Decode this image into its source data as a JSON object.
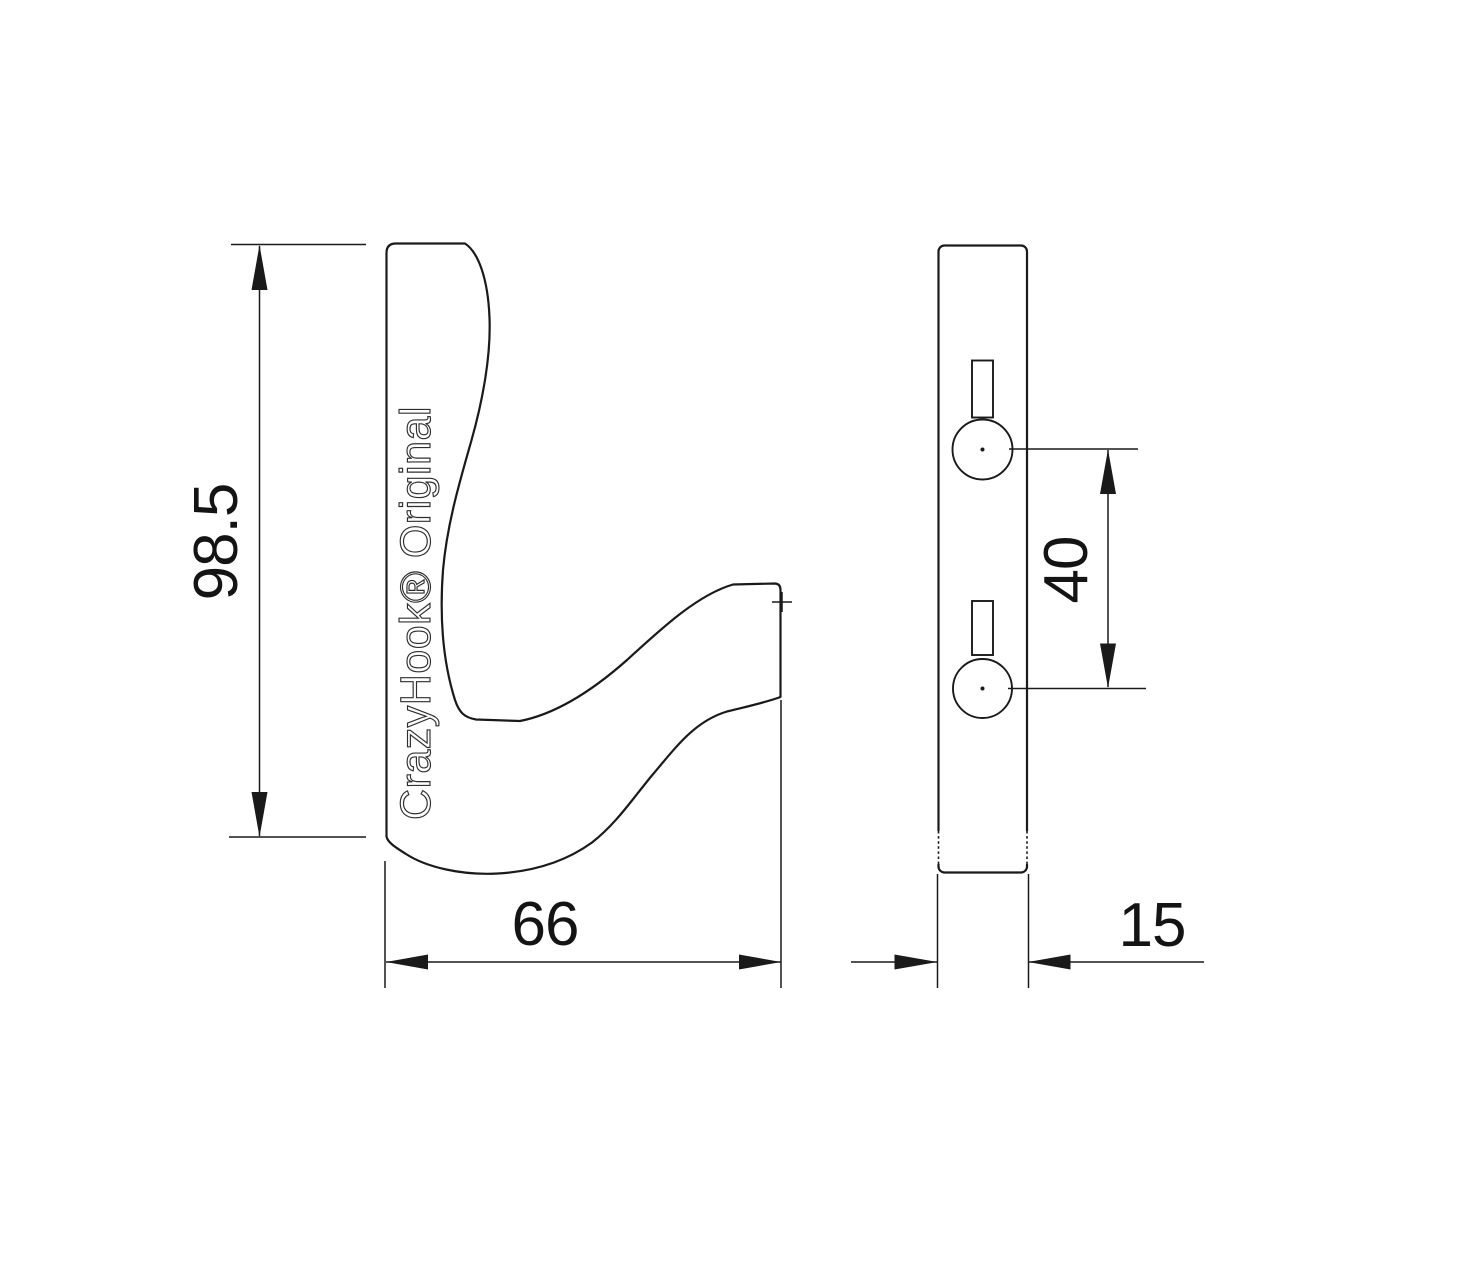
{
  "drawing": {
    "label": "CrazyHook® Original",
    "dimensions": {
      "height": "98.5",
      "width": "66",
      "hole_spacing": "40",
      "thickness": "15"
    },
    "colors": {
      "background": "#ffffff",
      "line": "#1a1a1a",
      "text": "#141414"
    }
  }
}
